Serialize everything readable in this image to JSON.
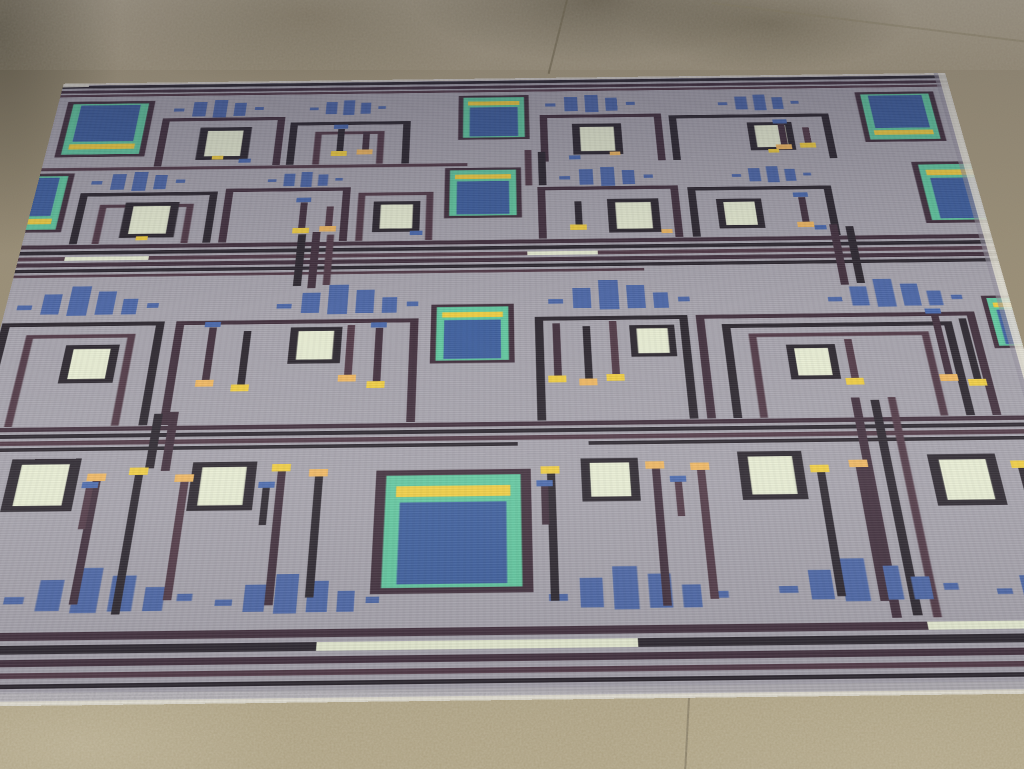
{
  "scene": {
    "type": "photograph",
    "description": "A flat-woven wool rug with a circuit-board inspired geometric pattern lying on an outdoor speckled concrete pavement in daylight, photographed in perspective with the far edge at the top.",
    "setting": "concrete pavement with expansion-joint seams, damp stains at top and light speckle at bottom",
    "subject": "rectangular kilim rug with circuit-board motifs"
  },
  "palette": {
    "floor-top": "#8a8173",
    "floor-bottom": "#a89c7e",
    "floor-stain": "#5f594a",
    "rug-gray": "#a7a4ae",
    "rug-gray-dark": "#9996a1",
    "line": "#443340",
    "line2": "#2f2a32",
    "line3": "#533c49",
    "blue": "#4e68a8",
    "blue-chip": "#40609f",
    "blue-cap": "#4b69ad",
    "teal": "#63c9a1",
    "yellow": "#f2cf45",
    "orange": "#f1b863",
    "cream": "#eaefd5",
    "selvedge": "#e6e2d5"
  },
  "rug": {
    "pattern": "circuit-board",
    "chip_description": "navy rectangle with mint-green frame, yellow stripe and dark aubergine outline",
    "motifs": {
      "chips": 9,
      "bar_groups": 17,
      "cream_boxes": 15,
      "pin_traces": 34,
      "stripe_bands": 4
    },
    "rows": [
      {
        "id": "top-border",
        "stripes": 3
      },
      {
        "id": "row-a",
        "chips": 3,
        "chip_style": "yellow-stripe-bottom",
        "bar_groups": 4,
        "cream_boxes": 3,
        "pin_traces": 4
      },
      {
        "id": "row-b",
        "chips": 3,
        "chip_style": "yellow-stripe-top",
        "bar_groups": 4,
        "cream_boxes": 4,
        "pin_traces": 4
      },
      {
        "id": "stripe-band-1",
        "stripes": 6,
        "cream_dashes": 2
      },
      {
        "id": "row-c",
        "chips": 2,
        "chip_style": "yellow-stripe-top",
        "bar_groups": 4,
        "cream_boxes": 4,
        "pin_traces": 10
      },
      {
        "id": "stripe-band-2",
        "stripes": 4
      },
      {
        "id": "row-d",
        "chips": 1,
        "chip_style": "yellow-stripe-top",
        "bar_groups": 5,
        "cream_boxes": 5,
        "pin_traces": 13
      },
      {
        "id": "bottom-border",
        "stripes": 5,
        "cream_dashes": 2
      }
    ]
  }
}
